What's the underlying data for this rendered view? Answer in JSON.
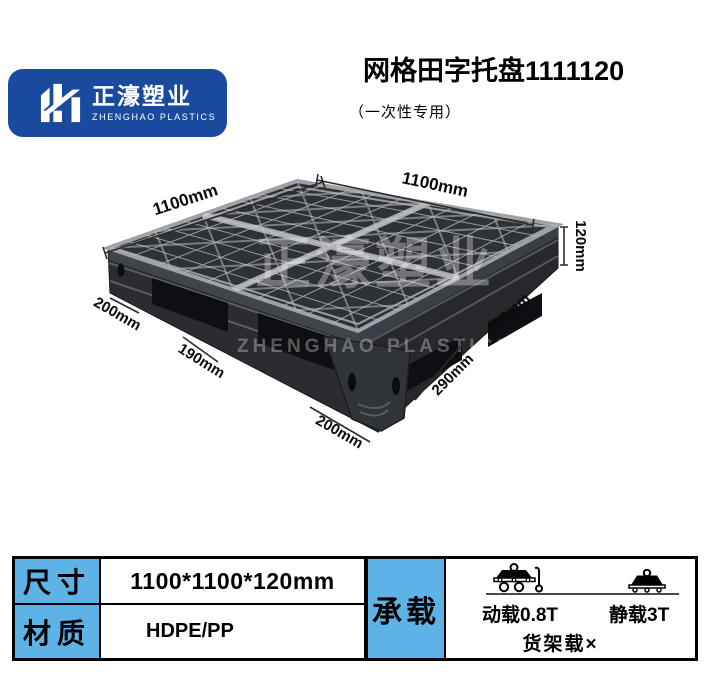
{
  "logo": {
    "cn": "正濠塑业",
    "en": "ZHENGHAO PLASTICS"
  },
  "header": {
    "title": "网格田字托盘1111120",
    "subtitle": "（一次性专用）"
  },
  "watermark": {
    "cn": "正濠塑业",
    "en": "ZHENGHAO PLASTICS"
  },
  "diagram": {
    "dim_top_left": "1100mm",
    "dim_top_right": "1100mm",
    "dim_height": "120mm",
    "dim_left_200": "200mm",
    "dim_left_190": "190mm",
    "dim_bottom_200": "200mm",
    "dim_right_290_lower": "290mm",
    "dim_right_290_upper": "290mm"
  },
  "spec_table": {
    "rows": [
      {
        "label": "尺寸",
        "value": "1100*1100*120mm"
      },
      {
        "label": "材质",
        "value": "HDPE/PP"
      }
    ],
    "load": {
      "label": "承载",
      "dynamic": "动载0.8T",
      "static": "静载3T",
      "rack": "货架载×"
    }
  },
  "colors": {
    "brand_blue": "#1a4a9e",
    "table_blue": "#5eb3e6",
    "pallet_dark": "#2e3136"
  }
}
